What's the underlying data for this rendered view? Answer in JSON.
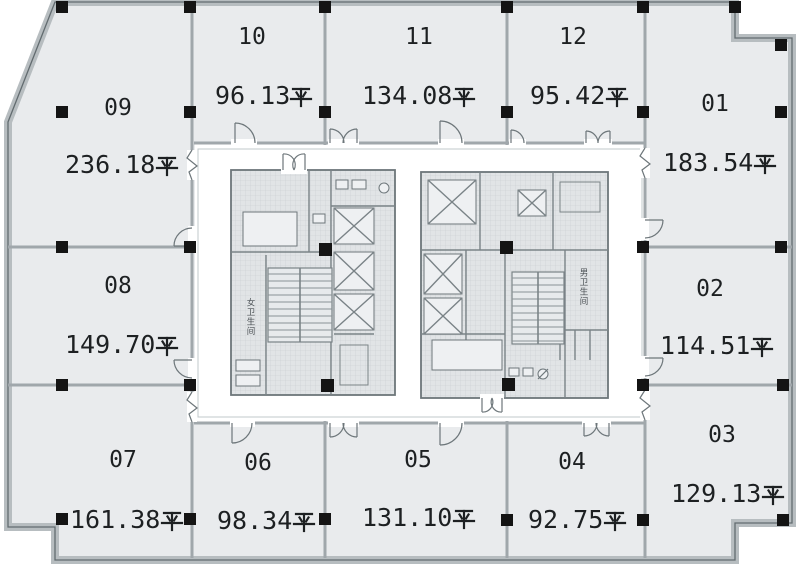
{
  "plan": {
    "type": "office-floor-plan",
    "units": [
      {
        "number": "01",
        "area": "183.54",
        "area_unit": "平"
      },
      {
        "number": "02",
        "area": "114.51",
        "area_unit": "平"
      },
      {
        "number": "03",
        "area": "129.13",
        "area_unit": "平"
      },
      {
        "number": "04",
        "area": "92.75",
        "area_unit": "平"
      },
      {
        "number": "05",
        "area": "131.10",
        "area_unit": "平"
      },
      {
        "number": "06",
        "area": "98.34",
        "area_unit": "平"
      },
      {
        "number": "07",
        "area": "161.38",
        "area_unit": "平"
      },
      {
        "number": "08",
        "area": "149.70",
        "area_unit": "平"
      },
      {
        "number": "09",
        "area": "236.18",
        "area_unit": "平"
      },
      {
        "number": "10",
        "area": "96.13",
        "area_unit": "平"
      },
      {
        "number": "11",
        "area": "134.08",
        "area_unit": "平"
      },
      {
        "number": "12",
        "area": "95.42",
        "area_unit": "平"
      }
    ],
    "core_labels": {
      "left": "女卫生间",
      "right": "男卫生间"
    },
    "colors": {
      "unit_fill": "#e9ebed",
      "corridor_fill": "#ffffff",
      "outer_wall_band": "#b7bdc0",
      "outline_dark": "#626b6f",
      "wall_line": "#a0a7ab",
      "column": "#141414",
      "core_fill": "#e1e4e6",
      "text": "#1d2022"
    }
  }
}
